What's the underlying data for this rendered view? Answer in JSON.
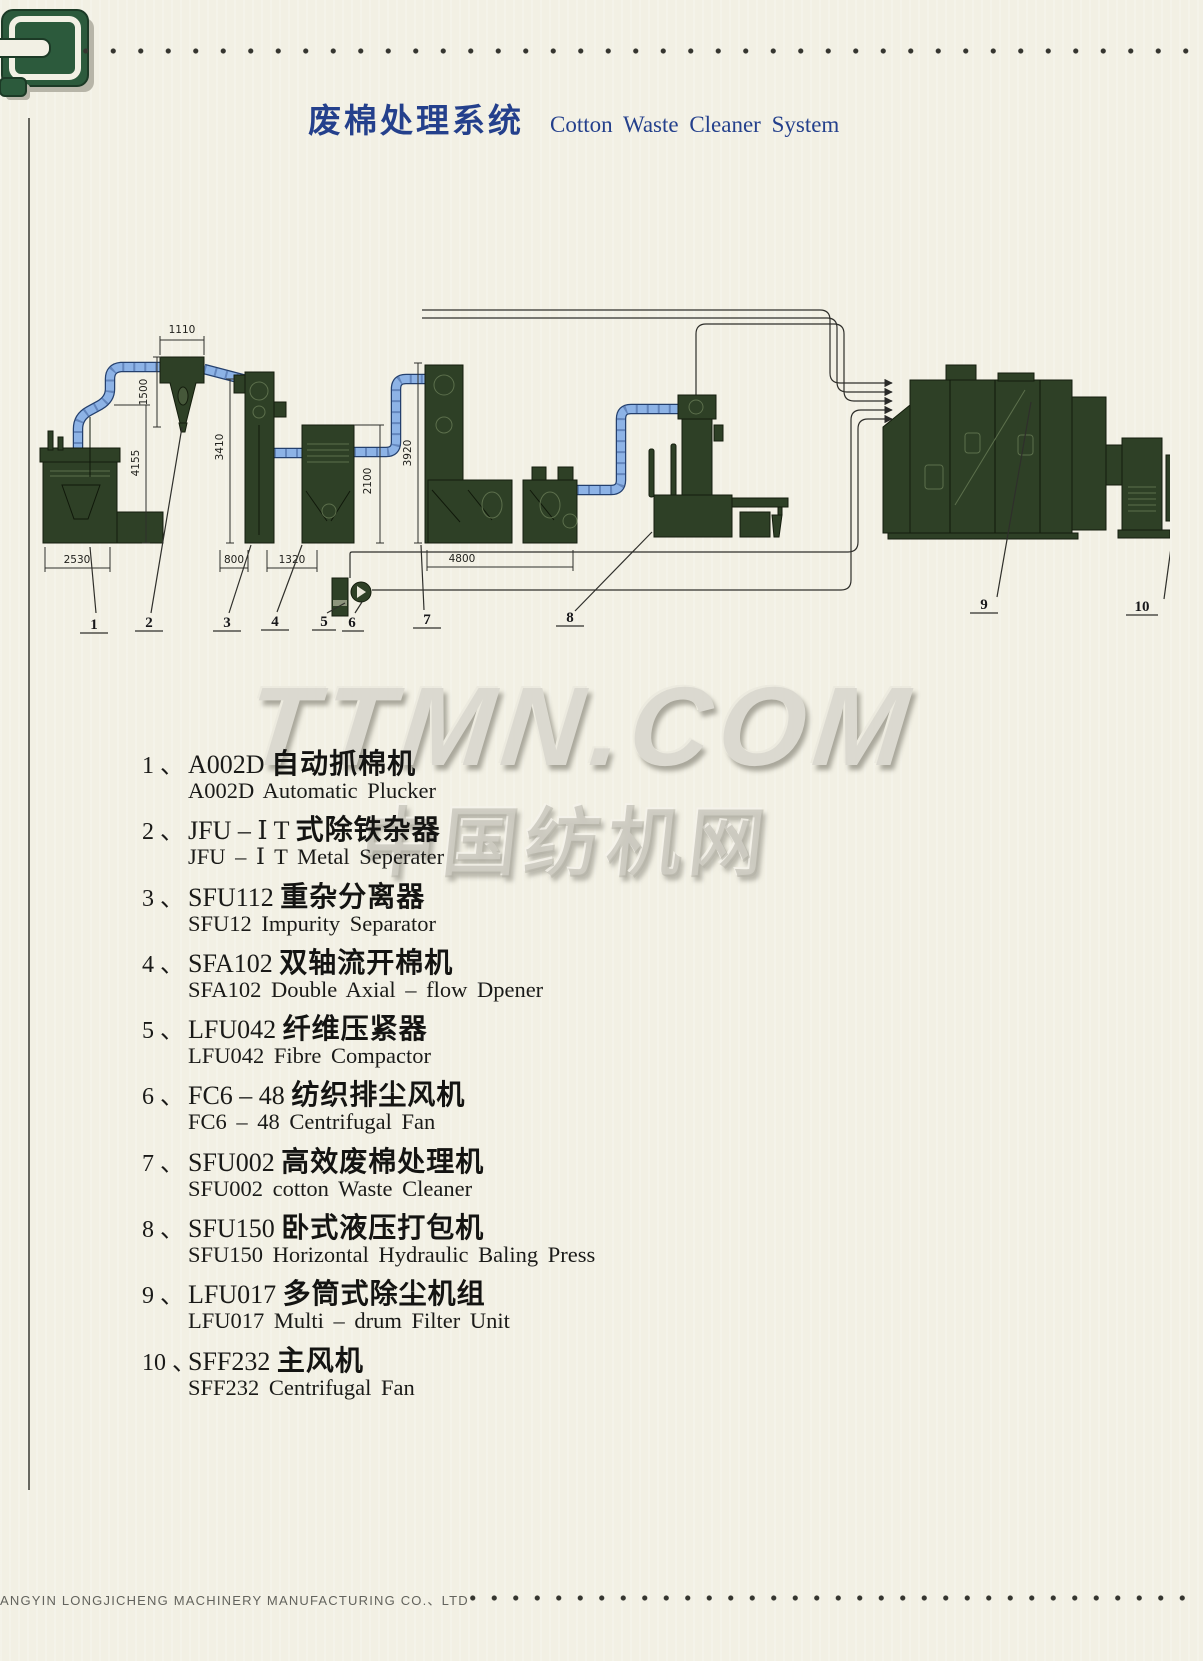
{
  "header": {
    "title_zh": "废棉处理系统",
    "title_en": "Cotton Waste Cleaner System"
  },
  "watermark": {
    "line1": "TTMN.COM",
    "line2": "中国纺机网"
  },
  "diagram": {
    "dims": {
      "w1110": "1110",
      "h1500": "1500",
      "h4155": "4155",
      "h3410": "3410",
      "h2100": "2100",
      "h3920": "3920",
      "w2530": "2530",
      "w800": "800",
      "w1320": "1320",
      "w4800": "4800"
    },
    "callouts": [
      "1",
      "2",
      "3",
      "4",
      "5",
      "6",
      "7",
      "8",
      "9",
      "10"
    ]
  },
  "equipment_list": [
    {
      "num": "1 、",
      "code": "A002D ",
      "zh": "自动抓棉机",
      "en": "A002D Automatic Plucker"
    },
    {
      "num": "2 、",
      "code": "JFU – Ⅰ T ",
      "zh": "式除铁杂器",
      "en": "JFU – Ⅰ T Metal Seperater"
    },
    {
      "num": "3 、",
      "code": "SFU112 ",
      "zh": "重杂分离器",
      "en": "SFU12 Impurity Separator"
    },
    {
      "num": "4 、",
      "code": "SFA102 ",
      "zh": "双轴流开棉机",
      "en": "SFA102 Double Axial – flow Dpener"
    },
    {
      "num": "5 、",
      "code": "LFU042 ",
      "zh": "纤维压紧器",
      "en": "LFU042 Fibre Compactor"
    },
    {
      "num": "6 、",
      "code": "FC6 – 48 ",
      "zh": "纺织排尘风机",
      "en": "FC6 – 48 Centrifugal Fan"
    },
    {
      "num": "7 、",
      "code": "SFU002 ",
      "zh": "高效废棉处理机",
      "en": "SFU002 cotton Waste Cleaner"
    },
    {
      "num": "8 、",
      "code": "SFU150 ",
      "zh": "卧式液压打包机",
      "en": "SFU150 Horizontal Hydraulic Baling Press"
    },
    {
      "num": "9 、",
      "code": "LFU017 ",
      "zh": "多筒式除尘机组",
      "en": "LFU017 Multi – drum Filter Unit"
    },
    {
      "num": "10 、",
      "code": "SFF232 ",
      "zh": "主风机",
      "en": "SFF232 Centrifugal Fan"
    }
  ],
  "footer": {
    "company": "ANGYIN LONGJICHENG MACHINERY MANUFACTURING CO.、LTD"
  },
  "colors": {
    "title_blue": "#24408c",
    "machine_green": "#2e4026",
    "pipe_blue": "#8db3e6",
    "logo_green": "#2c5a3c",
    "page_bg": "#f2f0e4"
  }
}
